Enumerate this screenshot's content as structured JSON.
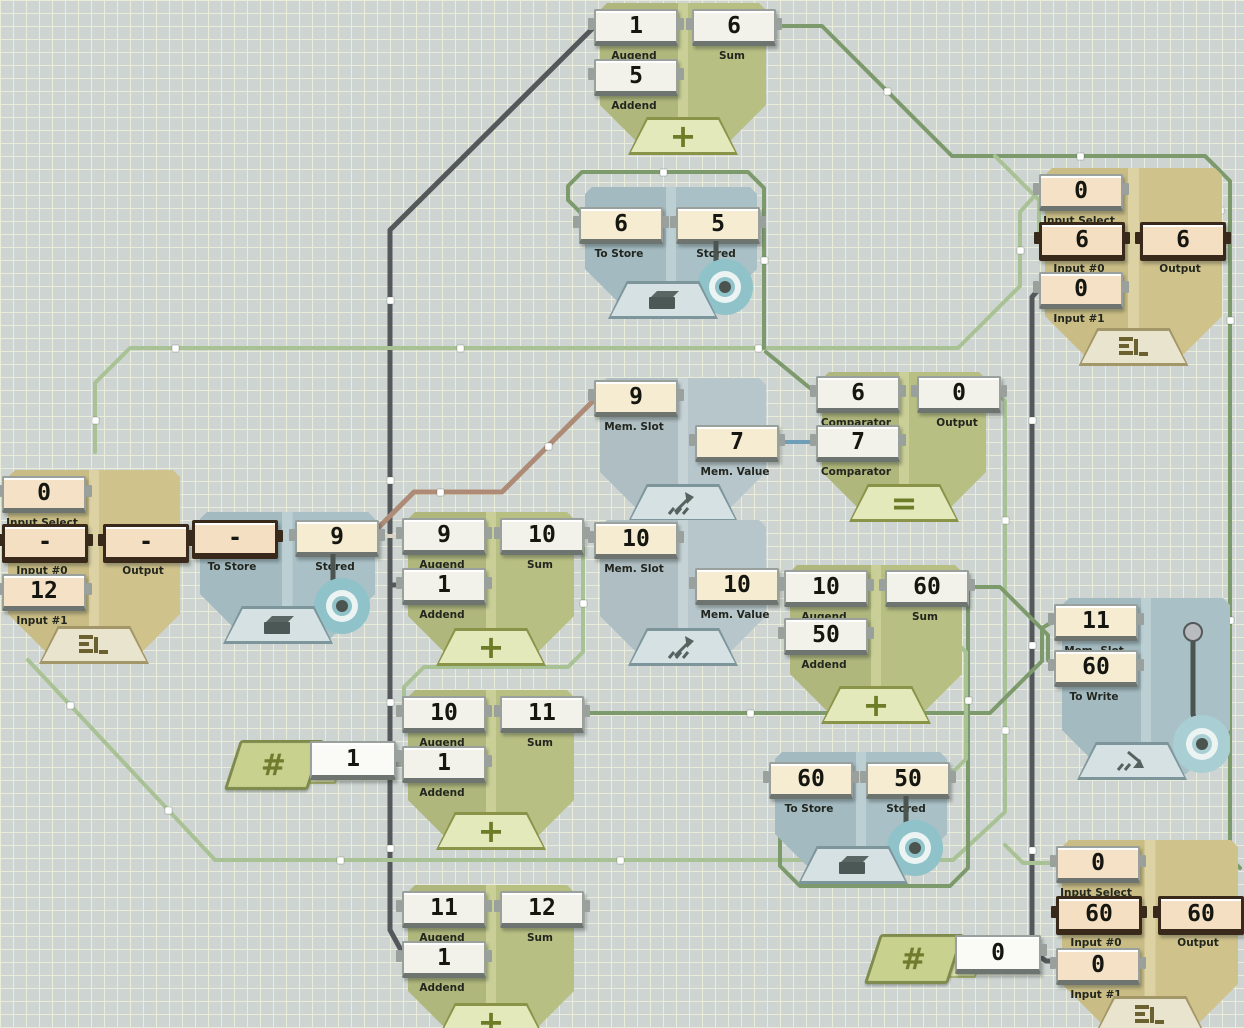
{
  "colors": {
    "background": "#cdd4d1",
    "grid_line": "#e8ecd8",
    "wire_gray": "#54585a",
    "wire_green_medium": "#7d9a6c",
    "wire_green_light": "#a9c295",
    "wire_brown": "#ad8b76",
    "wire_blue": "#6f9fb8",
    "wire_blue_light": "#9fc0cd",
    "wire_cream": "#d8d5c2",
    "signal_pulse": "#ffffff",
    "active_port_border": "#39291a"
  },
  "icons": {
    "plus": "+",
    "equals": "=",
    "hash": "#"
  },
  "nodes": {
    "adder1": {
      "type": "Adder",
      "ports": {
        "augend": {
          "label": "Augend",
          "value": "1"
        },
        "addend": {
          "label": "Addend",
          "value": "5"
        },
        "sum": {
          "label": "Sum",
          "value": "6"
        }
      }
    },
    "latch1": {
      "type": "Latch",
      "ports": {
        "to_store": {
          "label": "To Store",
          "value": "6"
        },
        "stored": {
          "label": "Stored",
          "value": "5"
        }
      }
    },
    "mux1": {
      "type": "Multiplexer",
      "ports": {
        "input_select": {
          "label": "Input Select",
          "value": "0"
        },
        "input0": {
          "label": "Input #0",
          "value": "6",
          "active": true
        },
        "input1": {
          "label": "Input #1",
          "value": "0"
        },
        "output": {
          "label": "Output",
          "value": "6",
          "active": true
        }
      }
    },
    "memread1": {
      "type": "Memory Read",
      "ports": {
        "mem_slot": {
          "label": "Mem. Slot",
          "value": "9"
        },
        "mem_value": {
          "label": "Mem. Value",
          "value": "7"
        }
      }
    },
    "equals1": {
      "type": "Equals",
      "ports": {
        "comparator_a": {
          "label": "Comparator",
          "value": "6"
        },
        "comparator_b": {
          "label": "Comparator",
          "value": "7"
        },
        "output": {
          "label": "Output",
          "value": "0"
        }
      }
    },
    "mux2": {
      "type": "Multiplexer",
      "ports": {
        "input_select": {
          "label": "Input Select",
          "value": "0"
        },
        "input0": {
          "label": "Input #0",
          "value": "-",
          "active": true
        },
        "input1": {
          "label": "Input #1",
          "value": "12"
        },
        "output": {
          "label": "Output",
          "value": "-",
          "active": true
        }
      }
    },
    "latch2": {
      "type": "Latch",
      "ports": {
        "to_store": {
          "label": "To Store",
          "value": "-",
          "active": true
        },
        "stored": {
          "label": "Stored",
          "value": "9"
        }
      }
    },
    "adder2": {
      "type": "Adder",
      "ports": {
        "augend": {
          "label": "Augend",
          "value": "9"
        },
        "addend": {
          "label": "Addend",
          "value": "1"
        },
        "sum": {
          "label": "Sum",
          "value": "10"
        }
      }
    },
    "memread2": {
      "type": "Memory Read",
      "ports": {
        "mem_slot": {
          "label": "Mem. Slot",
          "value": "10"
        },
        "mem_value": {
          "label": "Mem. Value",
          "value": "10"
        }
      }
    },
    "adder3": {
      "type": "Adder",
      "ports": {
        "augend": {
          "label": "Augend",
          "value": "10"
        },
        "addend": {
          "label": "Addend",
          "value": "50"
        },
        "sum": {
          "label": "Sum",
          "value": "60"
        }
      }
    },
    "memwrite1": {
      "type": "Memory Write",
      "ports": {
        "mem_slot": {
          "label": "Mem. Slot",
          "value": "11"
        },
        "to_write": {
          "label": "To Write",
          "value": "60"
        }
      }
    },
    "adder4": {
      "type": "Adder",
      "ports": {
        "augend": {
          "label": "Augend",
          "value": "10"
        },
        "addend": {
          "label": "Addend",
          "value": "1"
        },
        "sum": {
          "label": "Sum",
          "value": "11"
        }
      }
    },
    "const1": {
      "type": "Constant",
      "value": "1"
    },
    "latch3": {
      "type": "Latch",
      "ports": {
        "to_store": {
          "label": "To Store",
          "value": "60"
        },
        "stored": {
          "label": "Stored",
          "value": "50"
        }
      }
    },
    "adder5": {
      "type": "Adder",
      "ports": {
        "augend": {
          "label": "Augend",
          "value": "11"
        },
        "addend": {
          "label": "Addend",
          "value": "1"
        },
        "sum": {
          "label": "Sum",
          "value": "12"
        }
      }
    },
    "const2": {
      "type": "Constant",
      "value": "0"
    },
    "mux3": {
      "type": "Multiplexer",
      "ports": {
        "input_select": {
          "label": "Input Select",
          "value": "0"
        },
        "input0": {
          "label": "Input #0",
          "value": "60",
          "active": true
        },
        "input1": {
          "label": "Input #1",
          "value": "0"
        },
        "output": {
          "label": "Output",
          "value": "60",
          "active": true
        }
      }
    }
  }
}
